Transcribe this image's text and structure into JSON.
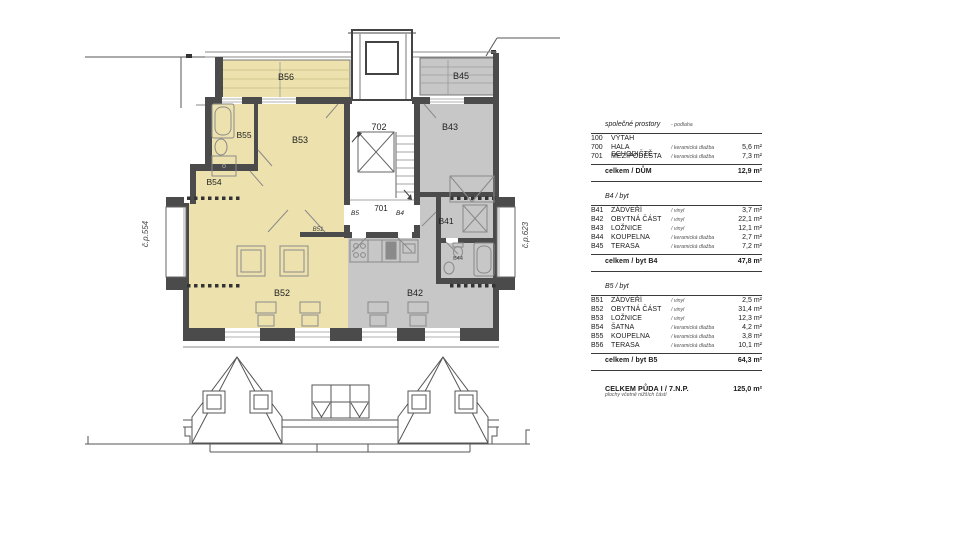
{
  "plan": {
    "house_left": "č.p.554",
    "house_right": "č.p.623",
    "labels": {
      "b56": "B56",
      "b45": "B45",
      "stair": "702",
      "landing": "701",
      "b43": "B43",
      "b55": "B55",
      "b53": "B53",
      "b54": "B54",
      "b41": "B41",
      "b44": "B44",
      "b51": "B51",
      "b52": "B52",
      "b42": "B42",
      "door_b5": "B5",
      "door_b4": "B4"
    },
    "colors": {
      "apartment_b5_fill": "#EDE2AE",
      "apartment_b4_fill": "#C7C7C7",
      "wall": "#4B4B4B"
    }
  },
  "table": {
    "sections": [
      {
        "header": "společné prostory",
        "header_note": "- podlaha",
        "rows": [
          {
            "code": "100",
            "name": "VÝTAH",
            "note": "",
            "area": ""
          },
          {
            "code": "700",
            "name": "HALA SCHODIŠTĚ",
            "note": "/ keramická dlažba",
            "area": "5,6 m²"
          },
          {
            "code": "701",
            "name": "MEZIPODESTA",
            "note": "/ keramická dlažba",
            "area": "7,3 m²"
          }
        ],
        "total_label": "celkem / DŮM",
        "total_area": "12,9 m²"
      },
      {
        "header": "B4 / byt",
        "header_note": "",
        "rows": [
          {
            "code": "B41",
            "name": "ZÁDVEŘÍ",
            "note": "/ vinyl",
            "area": "3,7 m²"
          },
          {
            "code": "B42",
            "name": "OBYTNÁ ČÁST",
            "note": "/ vinyl",
            "area": "22,1 m²"
          },
          {
            "code": "B43",
            "name": "LOŽNICE",
            "note": "/ vinyl",
            "area": "12,1 m²"
          },
          {
            "code": "B44",
            "name": "KOUPELNA",
            "note": "/ keramická dlažba",
            "area": "2,7 m²"
          },
          {
            "code": "B45",
            "name": "TERASA",
            "note": "/ keramická dlažba",
            "area": "7,2 m²"
          }
        ],
        "total_label": "celkem / byt B4",
        "total_area": "47,8 m²"
      },
      {
        "header": "B5 / byt",
        "header_note": "",
        "rows": [
          {
            "code": "B51",
            "name": "ZÁDVEŘÍ",
            "note": "/ vinyl",
            "area": "2,5 m²"
          },
          {
            "code": "B52",
            "name": "OBYTNÁ ČÁST",
            "note": "/ vinyl",
            "area": "31,4 m²"
          },
          {
            "code": "B53",
            "name": "LOŽNICE",
            "note": "/ vinyl",
            "area": "12,3 m²"
          },
          {
            "code": "B54",
            "name": "ŠATNA",
            "note": "/ keramická dlažba",
            "area": "4,2 m²"
          },
          {
            "code": "B55",
            "name": "KOUPELNA",
            "note": "/ keramická dlažba",
            "area": "3,8 m²"
          },
          {
            "code": "B56",
            "name": "TERASA",
            "note": "/ keramická dlažba",
            "area": "10,1 m²"
          }
        ],
        "total_label": "celkem / byt B5",
        "total_area": "64,3 m²"
      }
    ],
    "grand_total": {
      "label": "CELKEM PŮDA I / 7.N.P.",
      "area": "125,0 m²",
      "note": "plochy včetně nižších částí"
    }
  }
}
